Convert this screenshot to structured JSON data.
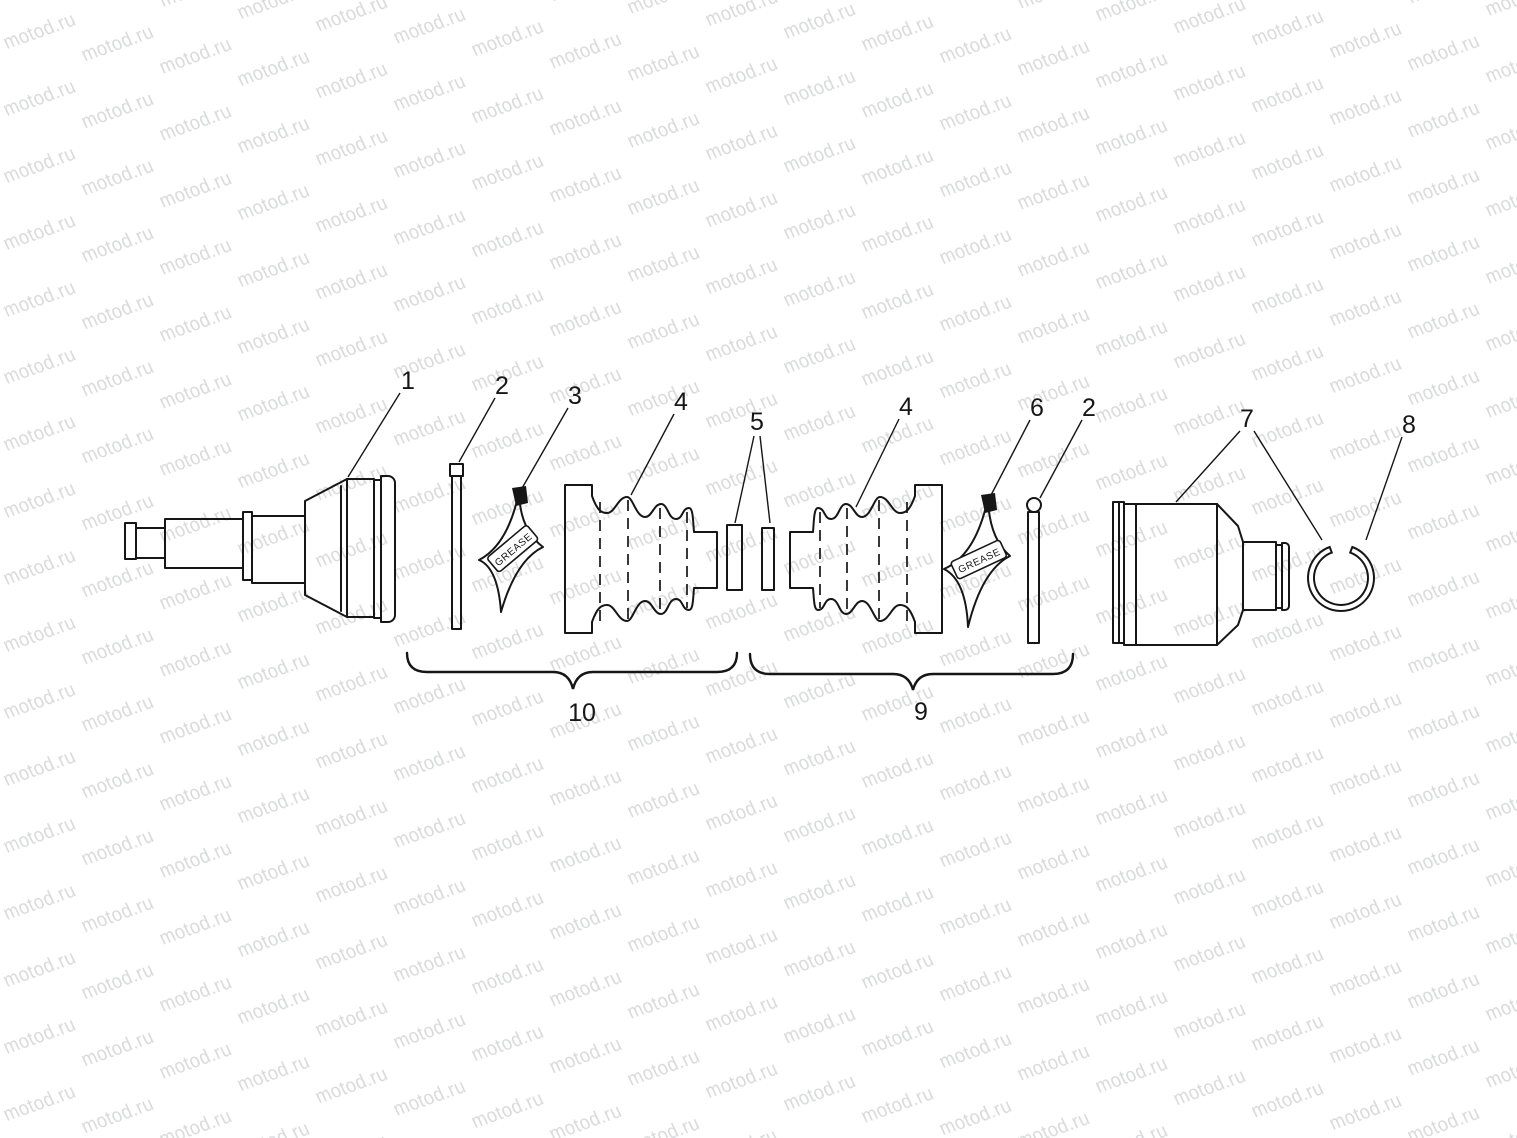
{
  "watermark": {
    "text": "motod.ru",
    "color": "#d8d9da"
  },
  "colors": {
    "background": "#ffffff",
    "line": "#161616"
  },
  "grease": {
    "label": "GREASE"
  },
  "callouts": {
    "c1": {
      "label": "1"
    },
    "c2a": {
      "label": "2"
    },
    "c3": {
      "label": "3"
    },
    "c4a": {
      "label": "4"
    },
    "c5": {
      "label": "5"
    },
    "c4b": {
      "label": "4"
    },
    "c6": {
      "label": "6"
    },
    "c2b": {
      "label": "2"
    },
    "c7": {
      "label": "7"
    },
    "c8": {
      "label": "8"
    },
    "c9": {
      "label": "9"
    },
    "c10": {
      "label": "10"
    }
  }
}
